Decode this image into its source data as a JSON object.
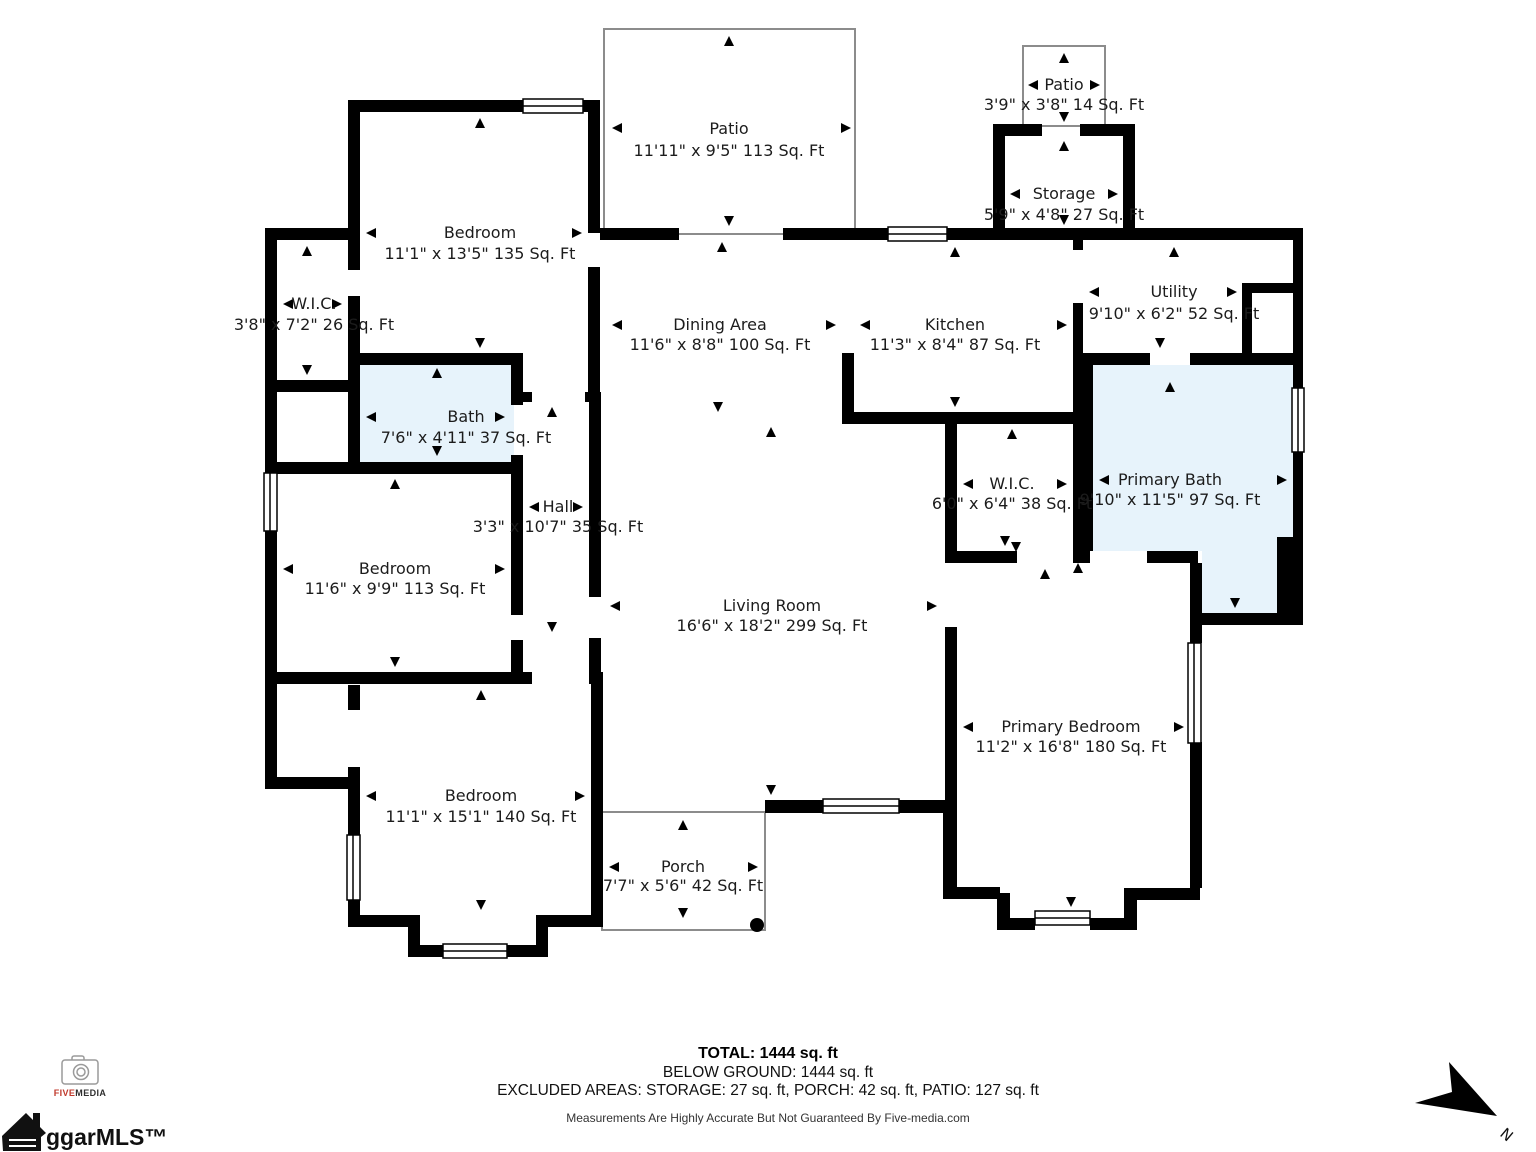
{
  "rooms": [
    {
      "name": "Patio",
      "dims": "11'11\" x 9'5\" 113 Sq. Ft"
    },
    {
      "name": "Patio",
      "dims": "3'9\" x 3'8\" 14 Sq. Ft"
    },
    {
      "name": "Storage",
      "dims": "5'9\" x 4'8\" 27 Sq. Ft"
    },
    {
      "name": "Bedroom",
      "dims": "11'1\" x 13'5\" 135 Sq. Ft"
    },
    {
      "name": "W.I.C.",
      "dims": "3'8\" x 7'2\" 26 Sq. Ft"
    },
    {
      "name": "Dining Area",
      "dims": "11'6\" x 8'8\" 100 Sq. Ft"
    },
    {
      "name": "Kitchen",
      "dims": "11'3\" x 8'4\" 87 Sq. Ft"
    },
    {
      "name": "Utility",
      "dims": "9'10\" x 6'2\" 52 Sq. Ft"
    },
    {
      "name": "Bath",
      "dims": "7'6\" x 4'11\" 37 Sq. Ft"
    },
    {
      "name": "Hall",
      "dims": "3'3\" x 10'7\" 35 Sq. Ft"
    },
    {
      "name": "Bedroom",
      "dims": "11'6\" x 9'9\" 113 Sq. Ft"
    },
    {
      "name": "W.I.C.",
      "dims": "6'0\" x 6'4\" 38 Sq. Ft"
    },
    {
      "name": "Primary Bath",
      "dims": "9'10\" x 11'5\" 97 Sq. Ft"
    },
    {
      "name": "Living Room",
      "dims": "16'6\" x 18'2\" 299 Sq. Ft"
    },
    {
      "name": "Bedroom",
      "dims": "11'1\" x 15'1\" 140 Sq. Ft"
    },
    {
      "name": "Primary Bedroom",
      "dims": "11'2\" x 16'8\" 180 Sq. Ft"
    },
    {
      "name": "Porch",
      "dims": "7'7\" x 5'6\" 42 Sq. Ft"
    }
  ],
  "footer": {
    "total": "TOTAL: 1444 sq. ft",
    "below_ground": "BELOW GROUND: 1444 sq. ft",
    "excluded": "EXCLUDED AREAS: STORAGE: 27 sq. ft, PORCH: 42 sq. ft, PATIO: 127 sq. ft",
    "disclaimer": "Measurements Are Highly Accurate But Not Guaranteed By Five-media.com"
  },
  "logos": {
    "photo_brand_left": "FIVE",
    "photo_brand_right": "MEDIA",
    "mls": "ggarMLS™"
  },
  "compass": {
    "label": "N"
  },
  "colors": {
    "wall": "#000000",
    "bath_fill": "#e7f3fb",
    "outline": "#8c8c8c",
    "brand_accent": "#c0392b"
  }
}
